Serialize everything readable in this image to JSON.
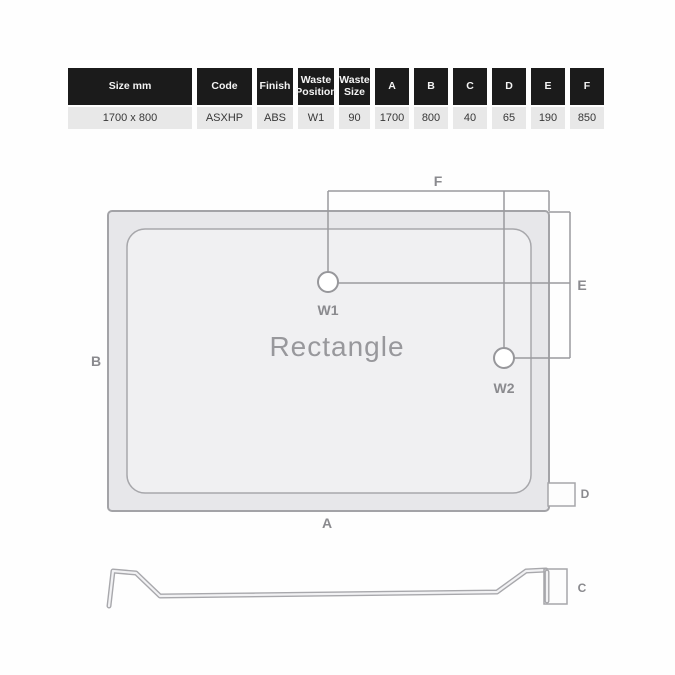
{
  "table": {
    "headers": [
      "Size mm",
      "Code",
      "Finish",
      "Waste Position",
      "Waste Size",
      "A",
      "B",
      "C",
      "D",
      "E",
      "F"
    ],
    "row": [
      "1700 x 800",
      "ASXHP",
      "ABS",
      "W1",
      "90",
      "1700",
      "800",
      "40",
      "65",
      "190",
      "850"
    ]
  },
  "plan": {
    "title": "Rectangle",
    "waste1_label": "W1",
    "waste2_label": "W2",
    "dim_a": "A",
    "dim_b": "B",
    "dim_d": "D",
    "dim_e": "E",
    "dim_f": "F"
  },
  "profile": {
    "dim_c": "C"
  },
  "colors": {
    "header_bg": "#1b1b1b",
    "row_bg": "#e8e8e8",
    "tray_fill": "#e7e7ea",
    "tray_inner_fill": "#f0f0f2",
    "line_gray": "#9a9a9e",
    "label_gray": "#8a8a8e"
  }
}
